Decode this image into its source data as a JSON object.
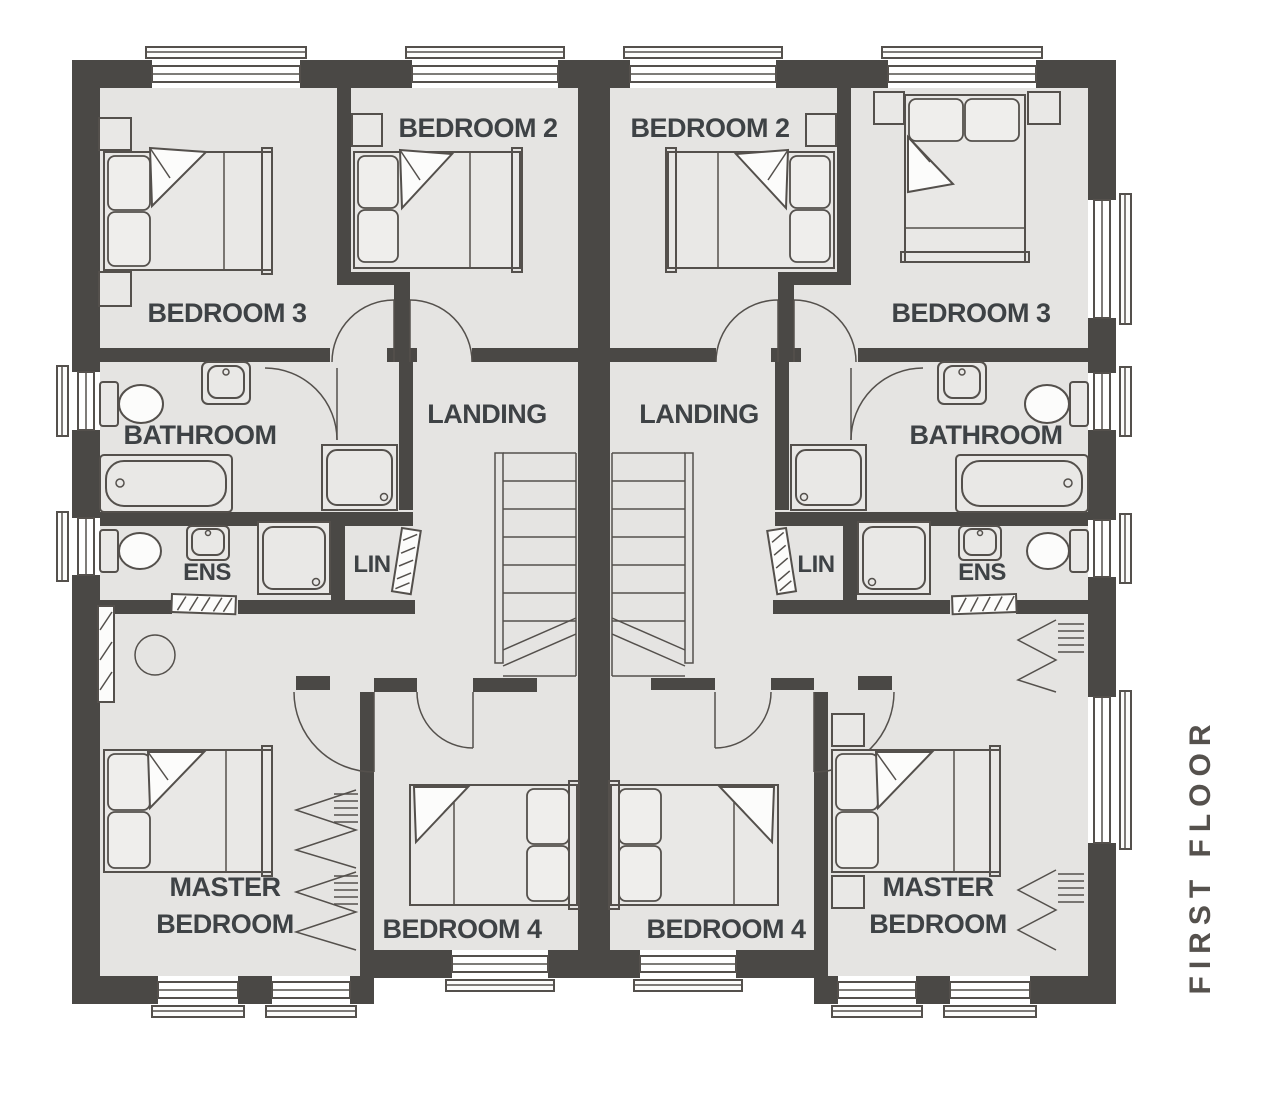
{
  "title": {
    "text": "FIRST FLOOR"
  },
  "colors": {
    "background": "#ffffff",
    "wall": "#4a4845",
    "floor": "#e5e4e2",
    "line": "#54504c",
    "label": "#3e4245",
    "title": "#55514d"
  },
  "units": {
    "left": {
      "bedroom3": "BEDROOM 3",
      "bedroom2": "BEDROOM 2",
      "bathroom": "BATHROOM",
      "ens": "ENS",
      "lin": "LIN",
      "landing": "LANDING",
      "master_line1": "MASTER",
      "master_line2": "BEDROOM",
      "bedroom4": "BEDROOM 4"
    },
    "right": {
      "bedroom2": "BEDROOM 2",
      "bedroom3": "BEDROOM 3",
      "bathroom": "BATHROOM",
      "ens": "ENS",
      "lin": "LIN",
      "landing": "LANDING",
      "master_line1": "MASTER",
      "master_line2": "BEDROOM",
      "bedroom4": "BEDROOM 4"
    }
  }
}
